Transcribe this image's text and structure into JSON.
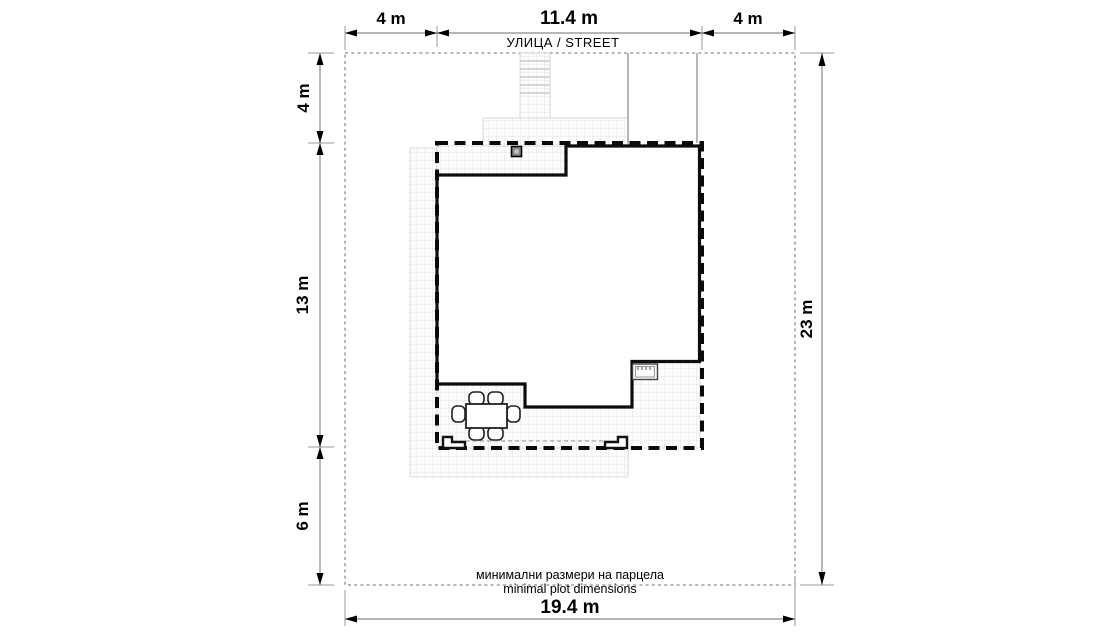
{
  "street_label": "УЛИЦА / STREET",
  "plot_note": {
    "bg": "минимални размери на парцела",
    "en": "minimal plot dimensions"
  },
  "dimensions": {
    "top": [
      "4 m",
      "11.4 m",
      "4 m"
    ],
    "left": [
      "4 m",
      "13 m",
      "6 m"
    ],
    "right": "23 m",
    "bottom": "19.4 m"
  },
  "colors": {
    "background": "#ffffff",
    "walls": "#0d0d0d",
    "roof_outline": "#0a0a0a",
    "plot_boundary": "#8c8c8c",
    "dimension_line": "#8a8a8a",
    "paving_grid": "#e3e3e3",
    "text": "#000000"
  }
}
